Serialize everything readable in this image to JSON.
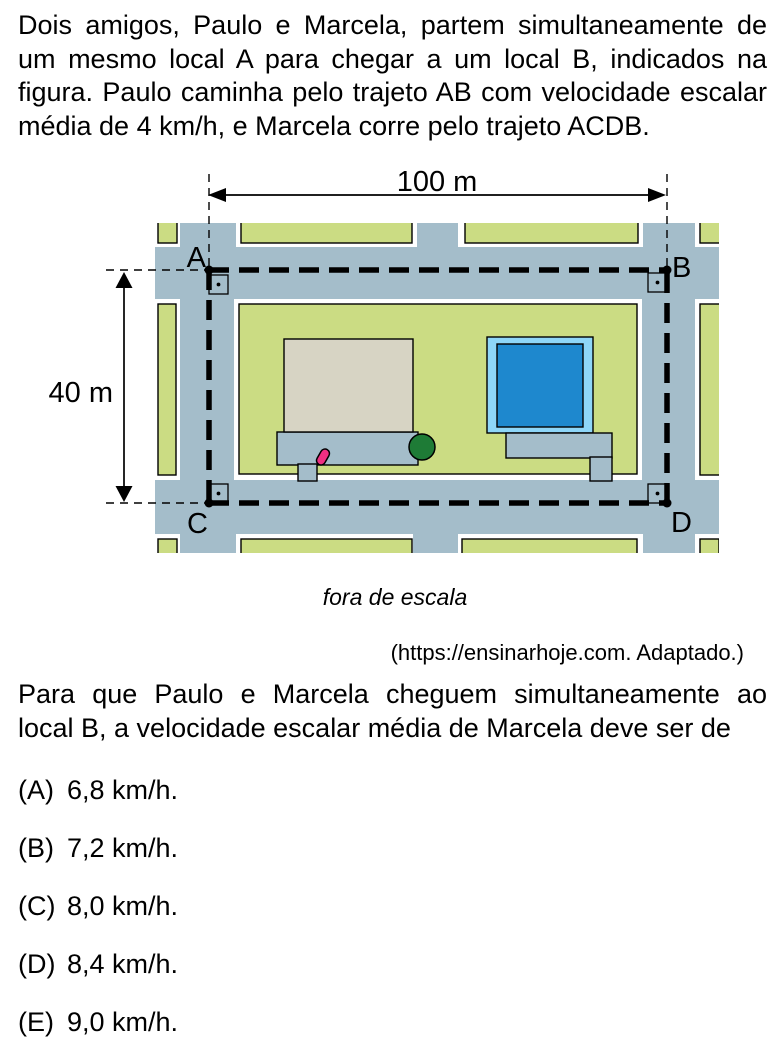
{
  "intro": {
    "lines": [
      "Dois amigos, Paulo e Marcela, partem simultaneamente de",
      "um mesmo local A para chegar a um local B, indicados na",
      "figura. Paulo caminha pelo trajeto AB com velocidade escalar",
      "média de 4 km/h, e Marcela corre pelo trajeto ACDB."
    ]
  },
  "figure": {
    "dim_width_label": "100 m",
    "dim_height_label": "40 m",
    "points": {
      "a": "A",
      "b": "B",
      "c": "C",
      "d": "D"
    },
    "caption": "fora de escala",
    "source": "(https://ensinarhoje.com. Adaptado.)"
  },
  "question": {
    "lines": [
      "Para que Paulo e Marcela cheguem simultaneamente ao",
      "local B, a velocidade escalar média de Marcela deve ser de"
    ]
  },
  "options": [
    {
      "label": "(A)",
      "value": "6,8 km/h."
    },
    {
      "label": "(B)",
      "value": "7,2 km/h."
    },
    {
      "label": "(C)",
      "value": "8,0 km/h."
    },
    {
      "label": "(D)",
      "value": "8,4 km/h."
    },
    {
      "label": "(E)",
      "value": "9,0 km/h."
    }
  ],
  "colors": {
    "page": "#ffffff",
    "ink": "#000000",
    "street": "#a4bdca",
    "block_green": "#cbdc83",
    "building": "#d7d4c4",
    "pool_frame": "#8ed6f8",
    "pool_water": "#1e88ce",
    "tree_green": "#1e7b36",
    "figure_pink": "#ef2f82"
  }
}
